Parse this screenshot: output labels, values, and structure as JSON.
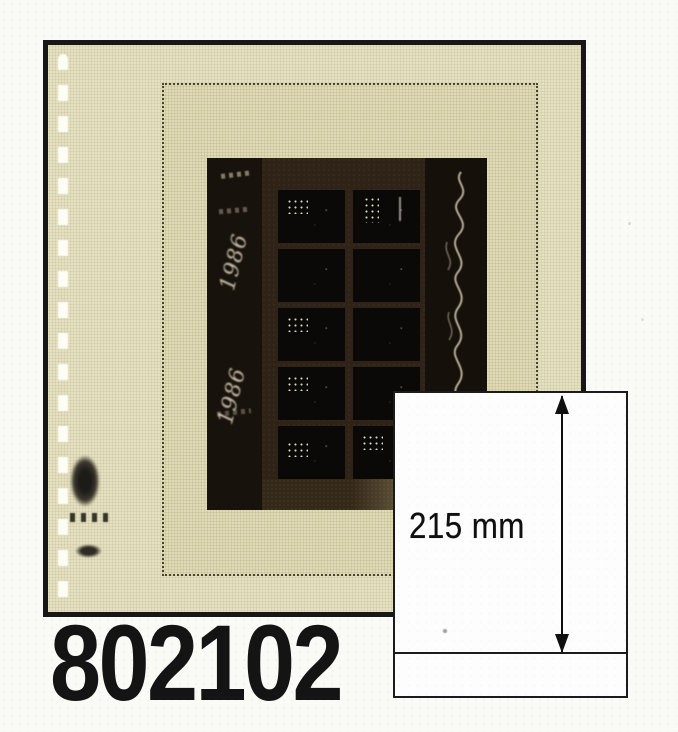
{
  "product": {
    "code": "802102"
  },
  "measurement": {
    "label": "215 mm"
  },
  "album_page": {
    "selvage_year": "1986"
  },
  "icons": {
    "measure_arrow": "double-headed-vertical-arrow",
    "punch_holes": "binder-punch-holes",
    "script_squiggle": "handwritten-script-marks"
  },
  "colors": {
    "background": "#fafaf7",
    "page_cream": "#eae5c6",
    "pocket_cream": "#e7e1bd",
    "frame_black": "#171717",
    "sheet_dark": "#261b11",
    "stamp_black": "#0b0908",
    "text_black": "#141414",
    "box_white": "#fdfdfd"
  }
}
